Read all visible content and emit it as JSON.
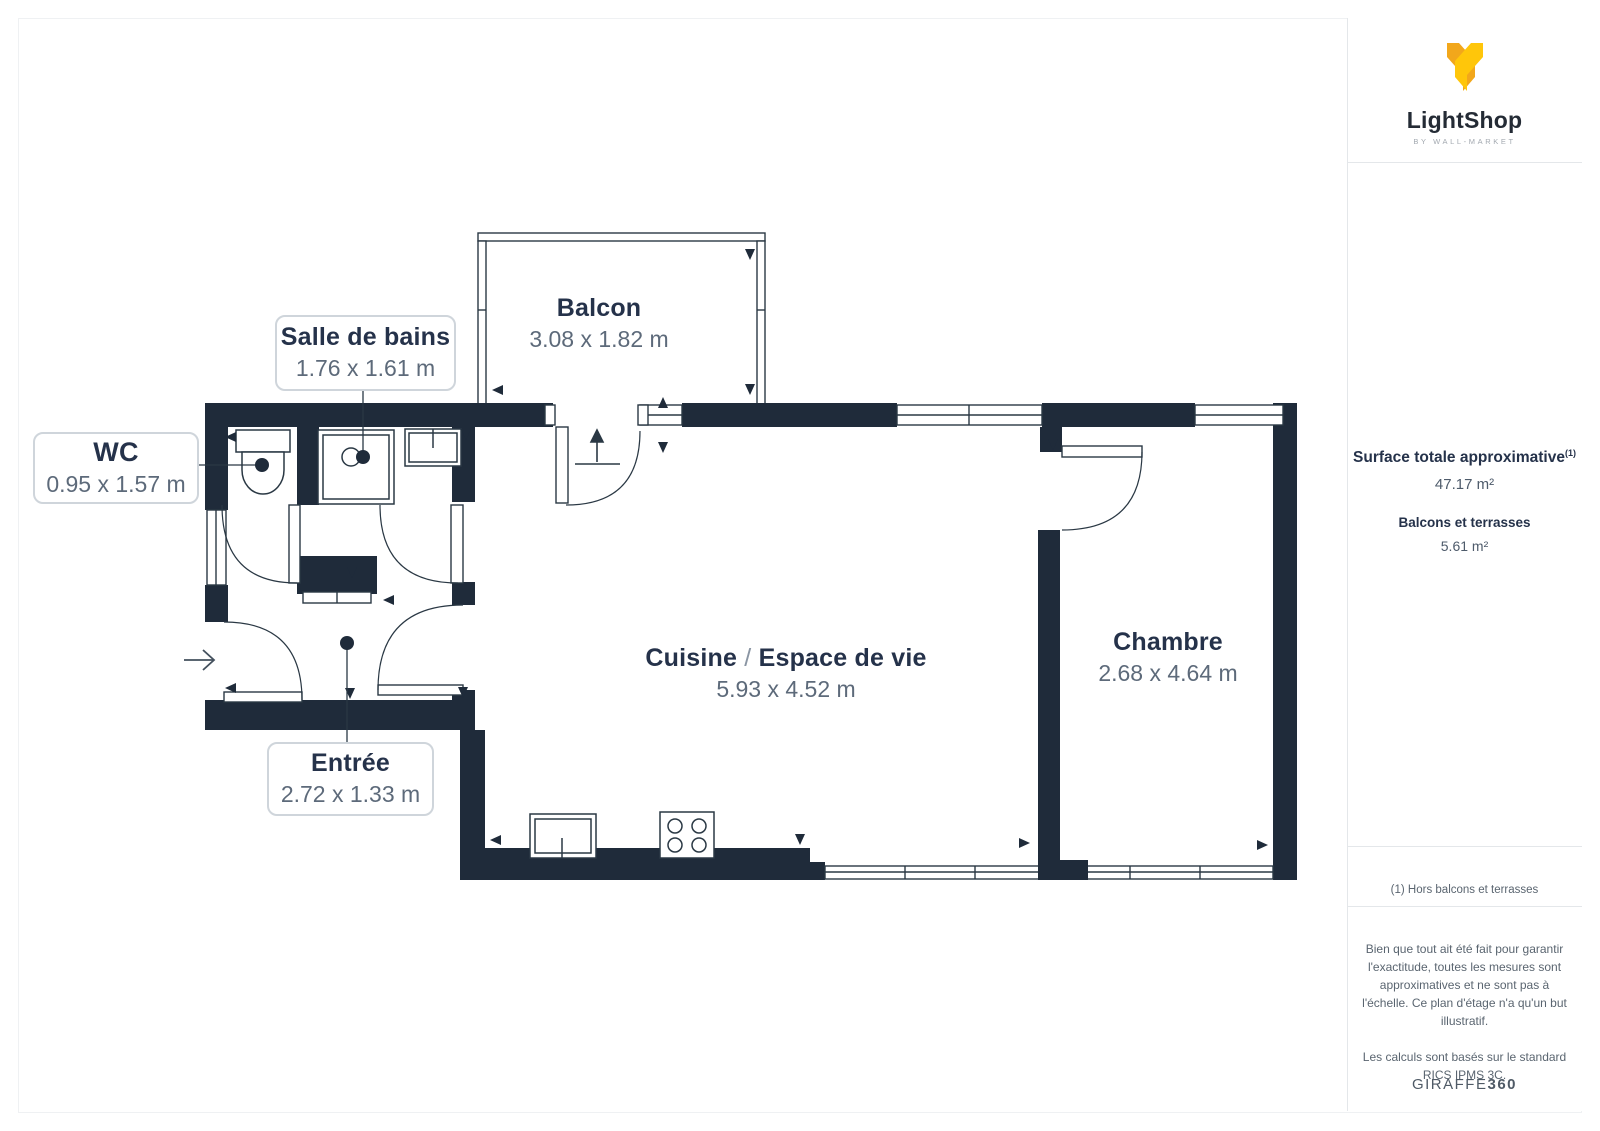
{
  "rooms": {
    "balcon": {
      "name": "Balcon",
      "dims": "3.08 x 1.82 m"
    },
    "salle_de_bains": {
      "name": "Salle de bains",
      "dims": "1.76 x 1.61 m"
    },
    "wc": {
      "name": "WC",
      "dims": "0.95 x 1.57 m"
    },
    "entree": {
      "name": "Entrée",
      "dims": "2.72 x 1.33 m"
    },
    "cuisine": {
      "name_left": "Cuisine",
      "separator": "/",
      "name_right": "Espace de vie",
      "dims": "5.93 x 4.52 m"
    },
    "chambre": {
      "name": "Chambre",
      "dims": "2.68 x 4.64 m"
    }
  },
  "sidebar": {
    "logo": {
      "name": "LightShop",
      "tagline": "BY WALL-MARKET"
    },
    "surface": {
      "title": "Surface totale approximative",
      "title_sup": "(1)",
      "value": "47.17 m²",
      "balcony_title": "Balcons et terrasses",
      "balcony_value": "5.61 m²"
    },
    "footnote": "(1) Hors balcons et terrasses",
    "disclaimer1": "Bien que tout ait été fait pour garantir l'exactitude, toutes les mesures sont approximatives et ne sont pas à l'échelle. Ce plan d'étage n'a qu'un but illustratif.",
    "disclaimer2": "Les calculs sont basés sur le standard RICS IPMS 3C.",
    "brand": {
      "giraffe": "GIRAFFE",
      "num": "360"
    }
  },
  "colors": {
    "wall": "#1F2B3A",
    "line": "#2A3844",
    "accent_amber": "#F2A71B",
    "accent_yellow": "#FFC60A"
  }
}
